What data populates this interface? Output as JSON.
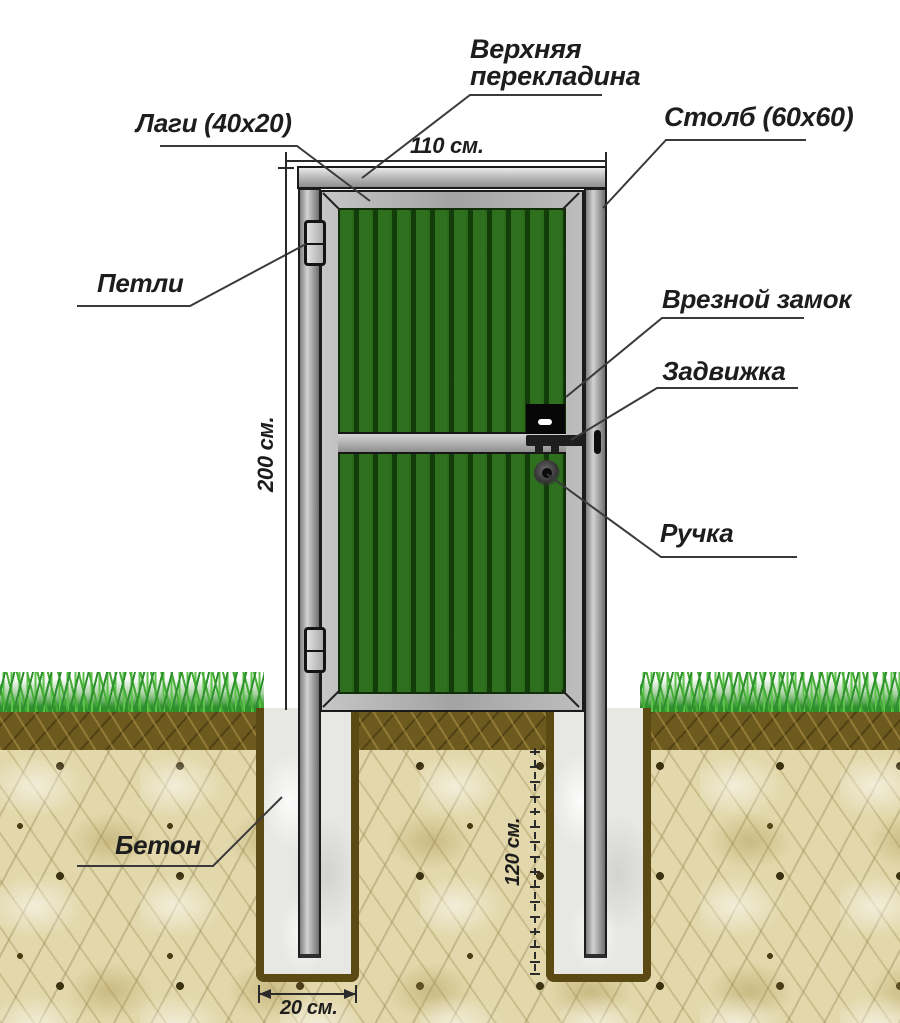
{
  "diagram_title": "Схема установки калитки из профнастила",
  "labels": {
    "top_crossbar": "Верхняя\nперекладина",
    "lags": "Лаги (40x20)",
    "post": "Столб (60x60)",
    "hinges": "Петли",
    "mortise_lock": "Врезной замок",
    "latch": "Задвижка",
    "handle": "Ручка",
    "concrete": "Бетон"
  },
  "dimensions": {
    "gate_width": "110 см.",
    "gate_height": "200 см.",
    "hole_depth": "120 см.",
    "hole_width": "20 см."
  },
  "colors": {
    "panel_green": "#2e6e1d",
    "ridge_green": "#123c0a",
    "metal_gray": "#b5b5b5",
    "grass_green": "#3fa439",
    "topsoil_brown": "#6d5a1f",
    "subsoil_tan": "#e2d8ab",
    "concrete_gray": "#e7e7e4",
    "hole_outline": "#5c4a15",
    "line_dark": "#3a3a3a"
  }
}
